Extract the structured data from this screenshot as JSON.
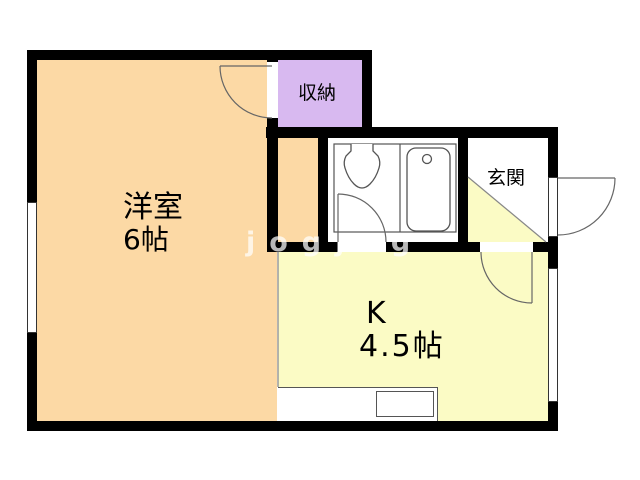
{
  "floorplan": {
    "type": "japanese-apartment-floorplan",
    "rooms": {
      "western_room": {
        "name": "洋室",
        "size": "6帖"
      },
      "kitchen": {
        "name": "K",
        "size": "4.5帖"
      },
      "closet": {
        "name": "収納"
      },
      "entrance": {
        "name": "玄関"
      },
      "bathroom": {
        "fixtures": [
          "toilet-icon",
          "bathtub-icon"
        ]
      }
    },
    "doors": [
      "closet-door-arc",
      "bathroom-door-arc",
      "kitchen-door-arc",
      "front-door-arc"
    ],
    "windows": [
      "left-window",
      "right-window"
    ],
    "watermark": "jogjog",
    "colors": {
      "western_room_fill": "#FCD9A5",
      "closet_fill": "#D8B9F0",
      "kitchen_fill": "#FBFBC5",
      "entrance_step_fill": "#FBFBC5",
      "wall": "#000000",
      "background": "#FFFFFF"
    }
  }
}
